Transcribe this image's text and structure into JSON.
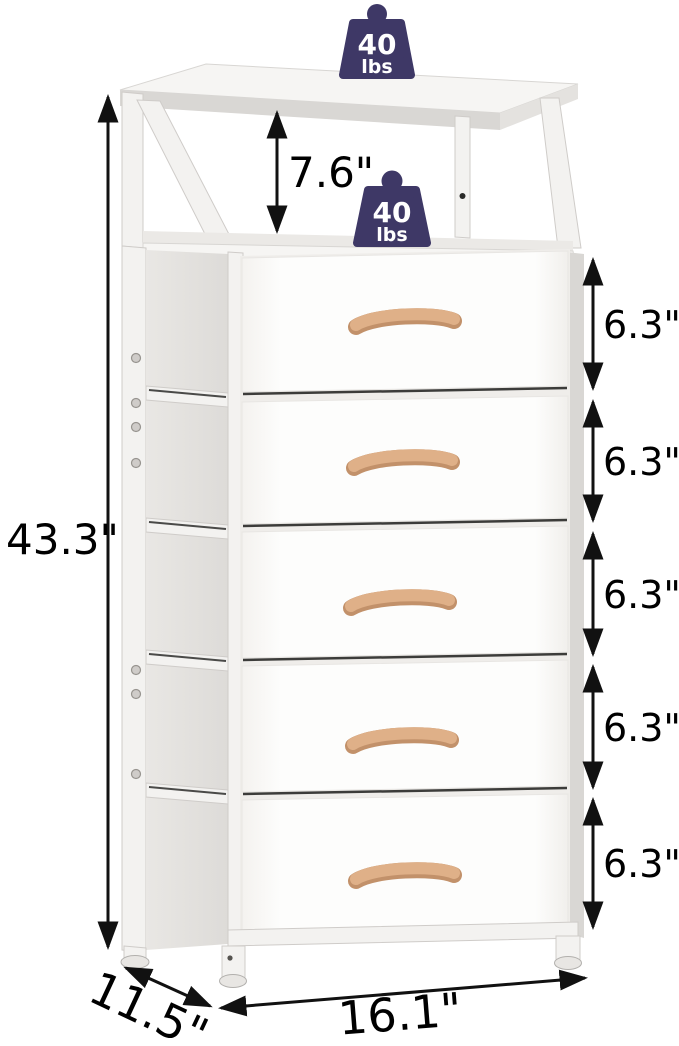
{
  "product_image": {
    "description": "White 5-drawer fabric dresser with open top shelf, metal frame and wooden handles"
  },
  "dimensions": {
    "overall_height": "43.3\"",
    "width": "16.1\"",
    "depth": "11.5\"",
    "open_shelf_height": "7.6\"",
    "drawer_heights": [
      "6.3\"",
      "6.3\"",
      "6.3\"",
      "6.3\"",
      "6.3\""
    ]
  },
  "weight_capacity": {
    "top": {
      "value": "40",
      "unit": "lbs",
      "icon": "weight-icon"
    },
    "middle_shelf": {
      "value": "40",
      "unit": "lbs",
      "icon": "weight-icon"
    }
  },
  "colors": {
    "weight_icon": "#3e3866",
    "dimension_text": "#000000",
    "arrow": "#111111",
    "frame": "#f3f2f0",
    "drawer_front": "#fdfdfc",
    "side_fabric": "#e6e4e1",
    "handle_wood": "#dfb088",
    "background": "#ffffff"
  }
}
